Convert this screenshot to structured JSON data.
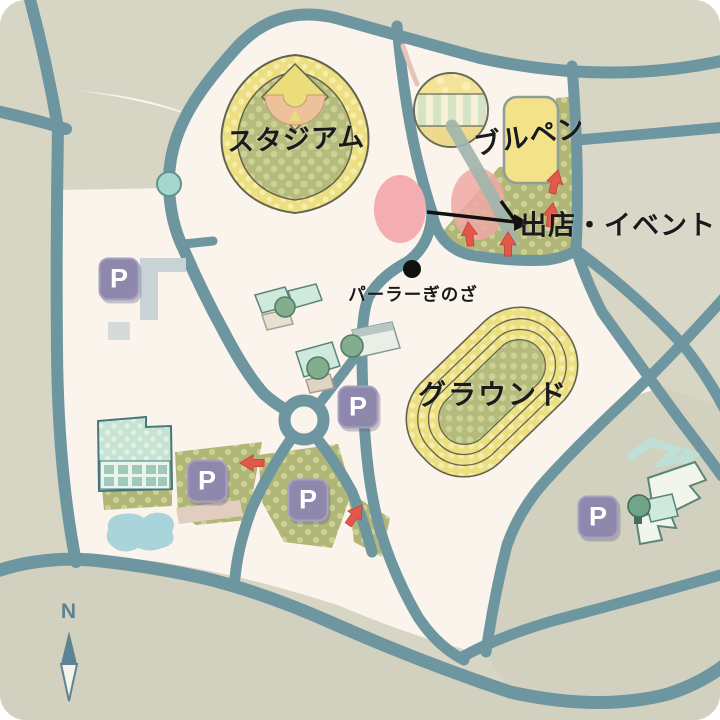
{
  "map": {
    "labels": {
      "stadium": "スタジアム",
      "bullpen": "ブルペン",
      "stalls_events": "出店・イベント",
      "parlor": "パーラーぎのざ",
      "ground": "グラウンド"
    },
    "compass_north": "N",
    "parking_badge": "P",
    "colors": {
      "background": "#d7d5c4",
      "park": "#faf4ec",
      "road": "#6e96a0",
      "track_yellow": "#ecdf82",
      "field_green": "#b4bb7d",
      "event_pink": "#f4adb0",
      "arrow_red": "#e4584a",
      "parking_purple": "#8e88ac",
      "water": "#a9d5da",
      "building_mint": "#c8e3d3",
      "label_black": "#1a1a1a",
      "compass_slate": "#5d8494"
    }
  }
}
